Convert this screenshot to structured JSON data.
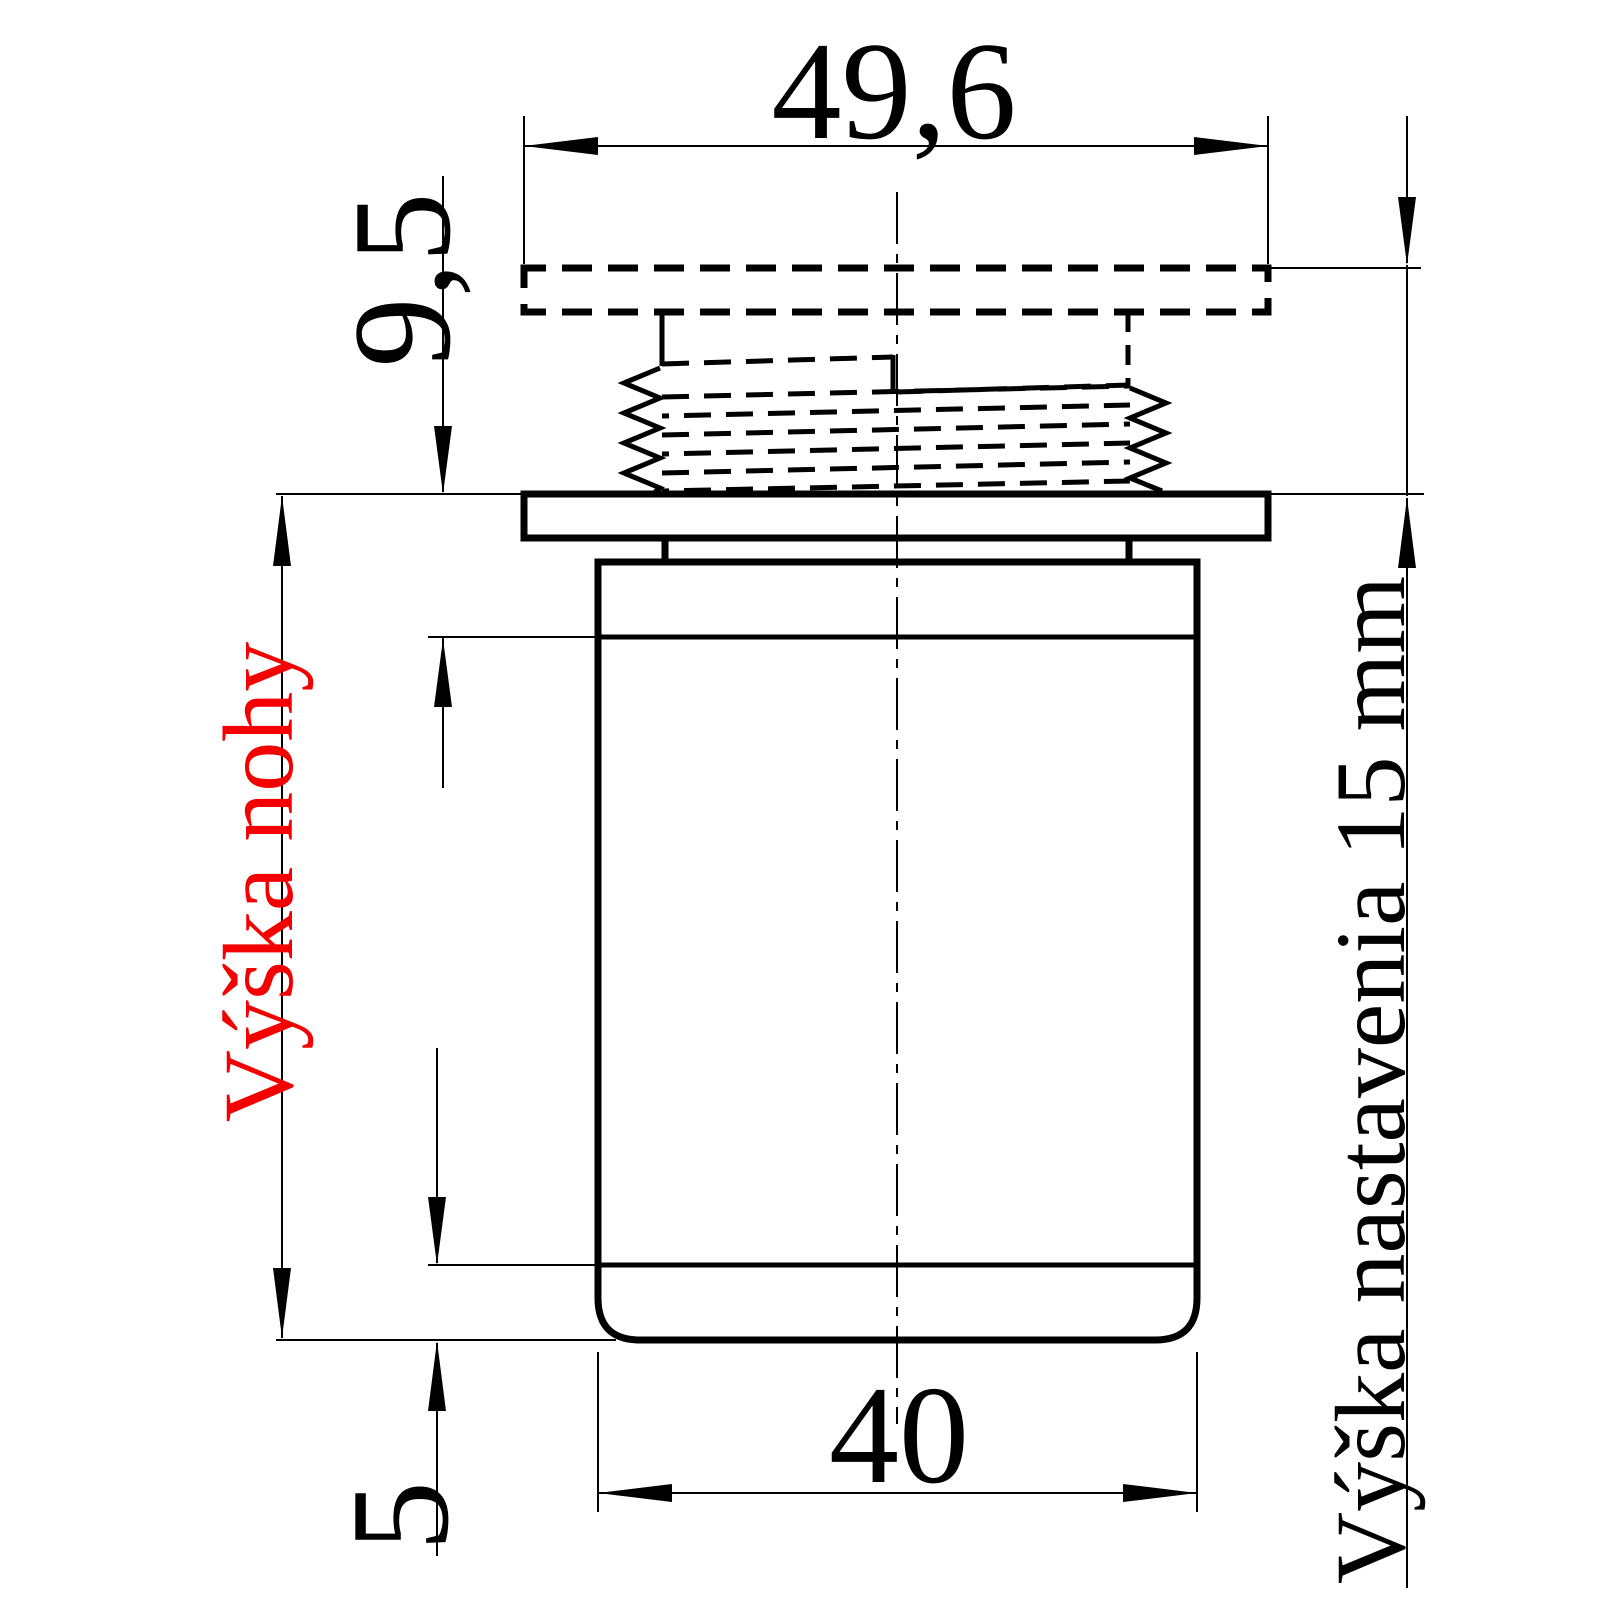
{
  "drawing": {
    "dim_top_width": "49,6",
    "dim_thread_height": "9,5",
    "dim_bottom_width": "40",
    "dim_bottom_band": "5",
    "label_leg_height": "Výška nohy",
    "label_adjustment": "Výška nastavenia 15 mm",
    "colors": {
      "line": "#000000",
      "leg_height_label": "#f40000"
    }
  }
}
